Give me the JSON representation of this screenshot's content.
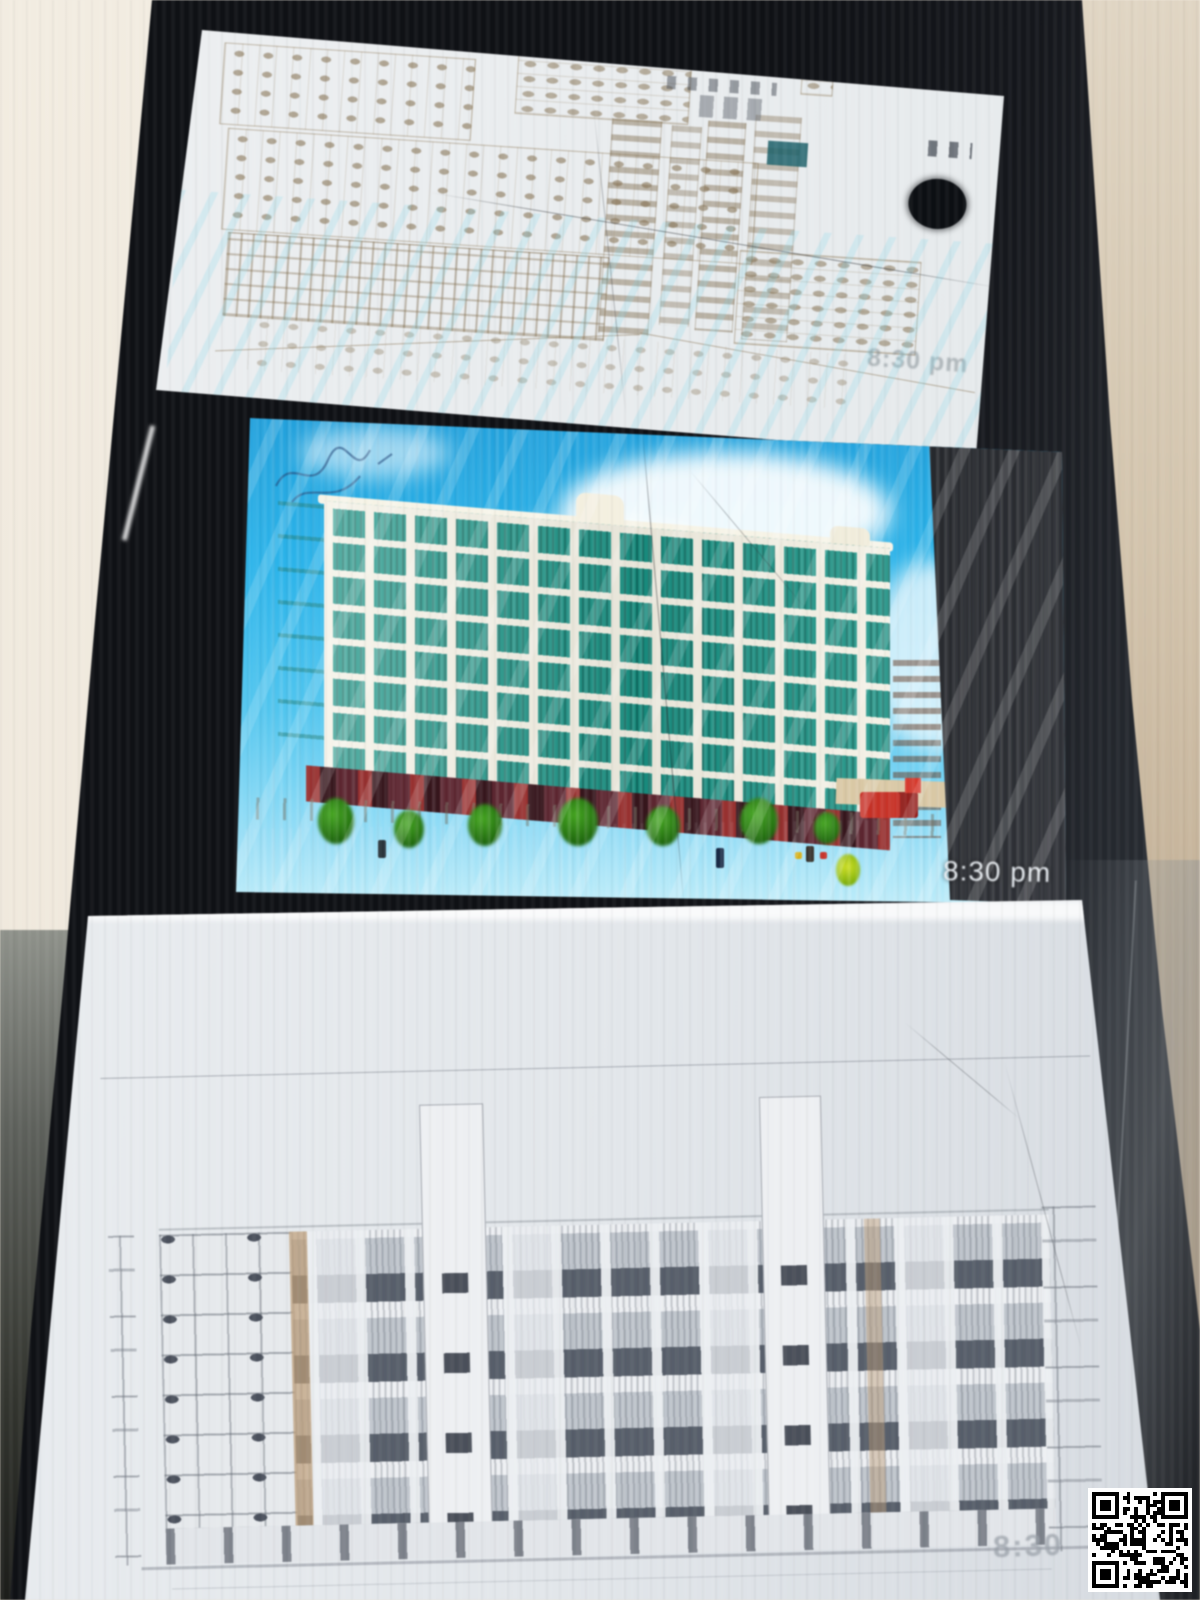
{
  "scene": {
    "kind": "photograph",
    "subject": "three printed phone screenshots of building drawings lying in a dark folder",
    "background_color": "#efe9dd",
    "folder_color": "#15171c"
  },
  "panels": {
    "top": {
      "name": "floor-plan-print",
      "timestamp": "8:30 pm"
    },
    "middle": {
      "name": "building-render-print",
      "timestamp": "8:30 pm",
      "sky_color": "#2fb2e6",
      "building_color": "#f2efe2",
      "window_color": "#1b8f82",
      "lawn_color": "#3fae1b",
      "visible_floors": 8
    },
    "bottom": {
      "name": "elevation-print",
      "timestamp": "8:30"
    }
  },
  "qr_code": {
    "position": "bottom-right",
    "modules": 25
  }
}
